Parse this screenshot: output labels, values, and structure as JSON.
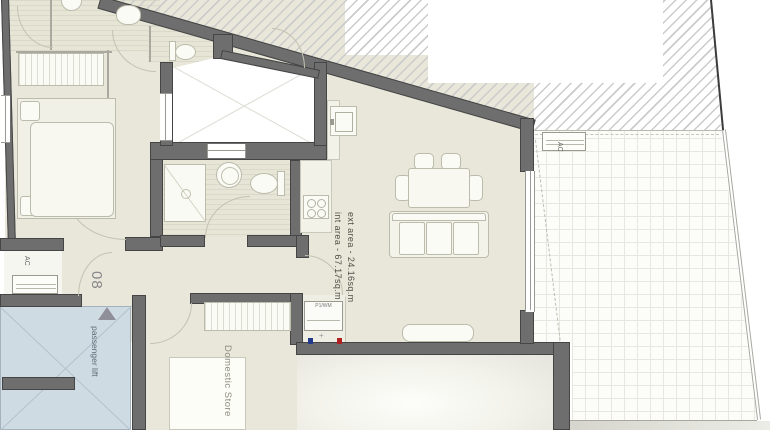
{
  "document": {
    "type": "apartment floor plan",
    "unit_number": "08"
  },
  "labels": {
    "int_area": "int area - 67.17sq.m",
    "ext_area": "ext area - 24.16sq.m",
    "passenger_lift": "passenger lift",
    "domestic_store": "Domestic Store",
    "apartment_number": "08",
    "ac": "AC",
    "washing_machine": "P1/WM",
    "plus_marker": "+"
  },
  "colors": {
    "wall": "#6e6e6e",
    "floor": "#e8e7d9",
    "lift_shaft": "#cfdbe3",
    "hatch": "#cbcbcb",
    "terrace_grid": "#e7e7e0",
    "label_text": "#6e6e66",
    "hot_water_point": "#b02020",
    "cold_water_point": "#223a8c",
    "entrance_arrow": "#8f8f99"
  }
}
